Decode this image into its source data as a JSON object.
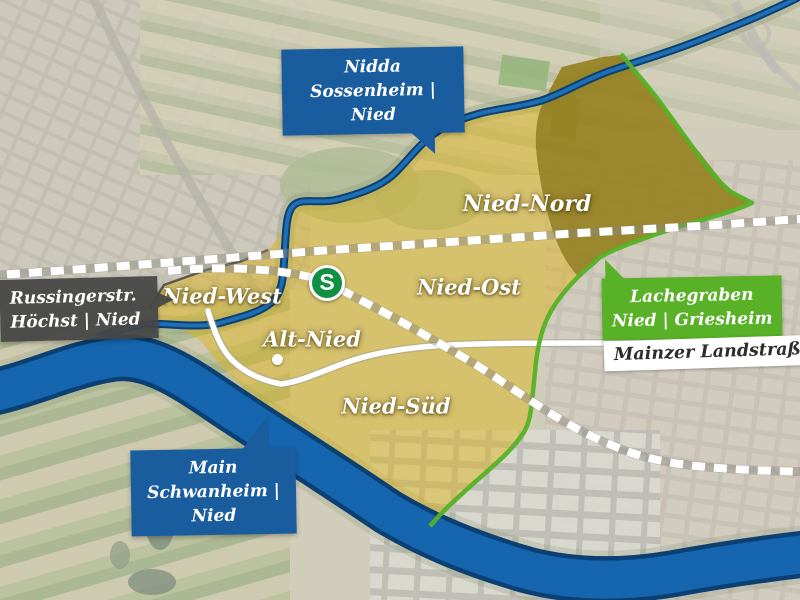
{
  "figure": {
    "type": "annotated aerial map of the Frankfurt district Nied",
    "callouts": {
      "nidda": {
        "title": "Nidda",
        "subtitle": "Sossenheim | Nied",
        "color": "#1a5d9e"
      },
      "russingerstrasse": {
        "title": "Russingerstr.",
        "subtitle": "Höchst | Nied",
        "color": "#464646"
      },
      "lachegraben": {
        "title": "Lachegraben",
        "subtitle": "Nied | Griesheim",
        "color": "#58b126"
      },
      "main_river": {
        "title": "Main",
        "subtitle": "Schwanheim | Nied",
        "color": "#1a5d9e"
      },
      "mainzer_landstrasse": {
        "label": "Mainzer Landstraße"
      }
    },
    "district_labels": {
      "nord": "Nied-Nord",
      "ost": "Nied-Ost",
      "west": "Nied-West",
      "alt": "Alt-Nied",
      "sued": "Nied-Süd"
    },
    "station": {
      "label": "S",
      "color": "#0f9043"
    },
    "colors": {
      "river": "#1566ae",
      "river_edge": "#0c3f72",
      "district_overlay": "#dcb41f",
      "boundary_green": "#56b125",
      "railway_dash": "#ffffff",
      "road": "#ffffff"
    }
  }
}
